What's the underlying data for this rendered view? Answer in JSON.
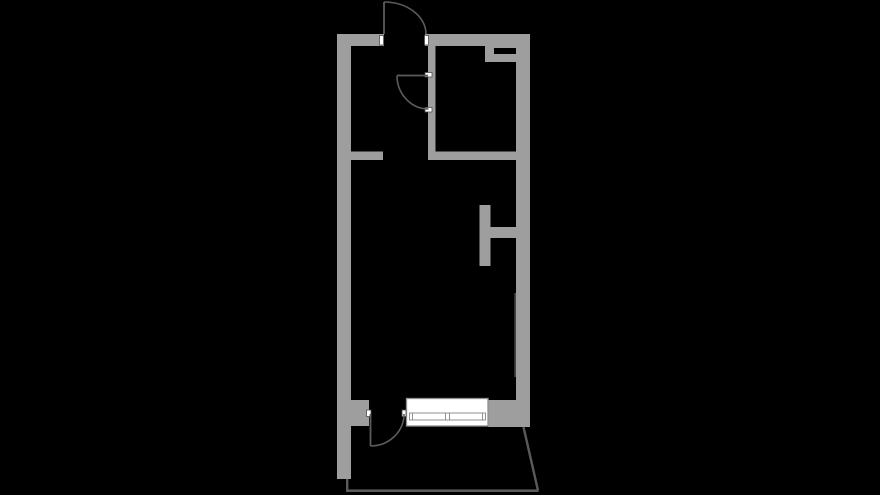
{
  "canvas": {
    "width": 880,
    "height": 495,
    "background": "#000000"
  },
  "palette": {
    "wall": "#9e9e9e",
    "door_line": "#5c5c5c",
    "balcony_line": "#5a5a5a",
    "jamb_fill": "#ffffff",
    "jamb_stroke": "#4f4f4f",
    "window_fill": "#ffffff",
    "window_stroke": "#8f8f8f",
    "vent_slot": "#000000",
    "radiator_line": "#454545"
  },
  "floor_plan": {
    "walls": [
      {
        "name": "top-wall-left-segment",
        "x": 337,
        "y": 34,
        "w": 47,
        "h": 12
      },
      {
        "name": "top-wall-right-segment",
        "x": 425,
        "y": 34,
        "w": 105,
        "h": 12
      },
      {
        "name": "left-exterior-wall",
        "x": 337,
        "y": 34,
        "w": 14,
        "h": 445
      },
      {
        "name": "right-exterior-wall",
        "x": 516,
        "y": 34,
        "w": 14,
        "h": 393
      },
      {
        "name": "hall-stub-wall",
        "x": 351,
        "y": 151.5,
        "w": 32,
        "h": 8.5
      },
      {
        "name": "inner-room-left-wall",
        "x": 428,
        "y": 46,
        "w": 7.5,
        "h": 114
      },
      {
        "name": "inner-room-bottom-wall",
        "x": 428,
        "y": 151.5,
        "w": 88,
        "h": 8.5
      },
      {
        "name": "vent-shaft-block",
        "x": 485,
        "y": 46,
        "w": 45,
        "h": 16
      },
      {
        "name": "partition-stub-wall",
        "x": 479.5,
        "y": 205,
        "w": 11,
        "h": 61
      },
      {
        "name": "partition-connector-wall",
        "x": 490,
        "y": 227,
        "w": 26,
        "h": 11
      },
      {
        "name": "bottom-wall-left-block",
        "x": 351,
        "y": 400,
        "w": 18,
        "h": 26
      },
      {
        "name": "bottom-wall-right-block",
        "x": 488,
        "y": 400,
        "w": 42,
        "h": 27
      }
    ],
    "vent_slot": {
      "name": "vent-shaft-slot",
      "x": 494,
      "y": 48,
      "w": 22,
      "h": 6
    },
    "radiator": {
      "name": "wall-radiator-line",
      "x": 514.3,
      "y": 293,
      "w": 1.7,
      "h": 84
    },
    "doors": [
      {
        "name": "entry-door",
        "leaf": "M 384,2 L 384,34",
        "arc": "M 384,2 A 42,32 0 0 1 426,34"
      },
      {
        "name": "bathroom-door",
        "leaf": "M 397,75.5 L 428,75.5",
        "arc": "M 397,75.5 A 31.5,33.5 0 0 0 428.5,109"
      },
      {
        "name": "balcony-door",
        "leaf": "M 370.5,414 L 370.5,446",
        "arc": "M 370.5,446 A 33.5,32 0 0 0 404,414"
      }
    ],
    "jambs": [
      {
        "name": "entry-door-left-jamb",
        "x": 379.5,
        "y": 35.5,
        "w": 4,
        "h": 9.5
      },
      {
        "name": "entry-door-right-jamb",
        "x": 424.5,
        "y": 35.5,
        "w": 4,
        "h": 9.5
      },
      {
        "name": "bathroom-door-top-jamb",
        "x": 425,
        "y": 72.5,
        "w": 7,
        "h": 4.5
      },
      {
        "name": "bathroom-door-bottom-jamb",
        "x": 425,
        "y": 107.5,
        "w": 7,
        "h": 4.5
      },
      {
        "name": "balcony-door-left-jamb",
        "x": 366.5,
        "y": 410,
        "w": 4.5,
        "h": 6.5
      },
      {
        "name": "balcony-door-right-jamb",
        "x": 402,
        "y": 410,
        "w": 4,
        "h": 6.5
      }
    ],
    "window": {
      "name": "main-window",
      "outer": {
        "x": 406.5,
        "y": 398.5,
        "w": 81.5,
        "h": 27.5
      },
      "bar": {
        "x": 409.5,
        "y": 413,
        "w": 76,
        "h": 7
      },
      "dividers_x": [
        412.5,
        445.5,
        449.5,
        482.5
      ],
      "divider_y1": 413,
      "divider_y2": 420
    },
    "balcony_lines": [
      {
        "name": "balcony-left-line",
        "x1": 347.2,
        "y1": 479,
        "x2": 347.2,
        "y2": 490.7,
        "sw": 2.4
      },
      {
        "name": "balcony-bottom-line",
        "x1": 346,
        "y1": 490.7,
        "x2": 538.5,
        "y2": 490.7,
        "sw": 2.6
      },
      {
        "name": "balcony-right-diagonal-line",
        "x1": 523.5,
        "y1": 427,
        "x2": 538,
        "y2": 490.5,
        "sw": 2.4
      }
    ]
  }
}
